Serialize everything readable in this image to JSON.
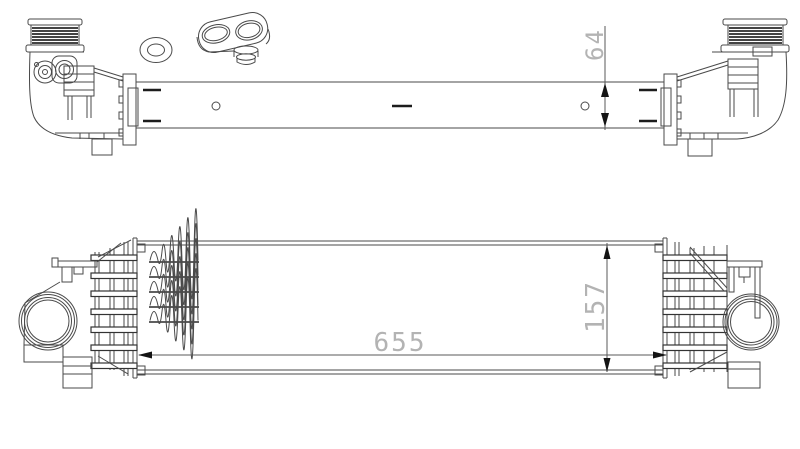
{
  "dimensions": {
    "depth": "64",
    "length": "655",
    "height": "157"
  },
  "colors": {
    "background": "#ffffff",
    "line": "#4a4a4a",
    "dimension_text": "#b3b3b3",
    "arrow": "#141414"
  }
}
